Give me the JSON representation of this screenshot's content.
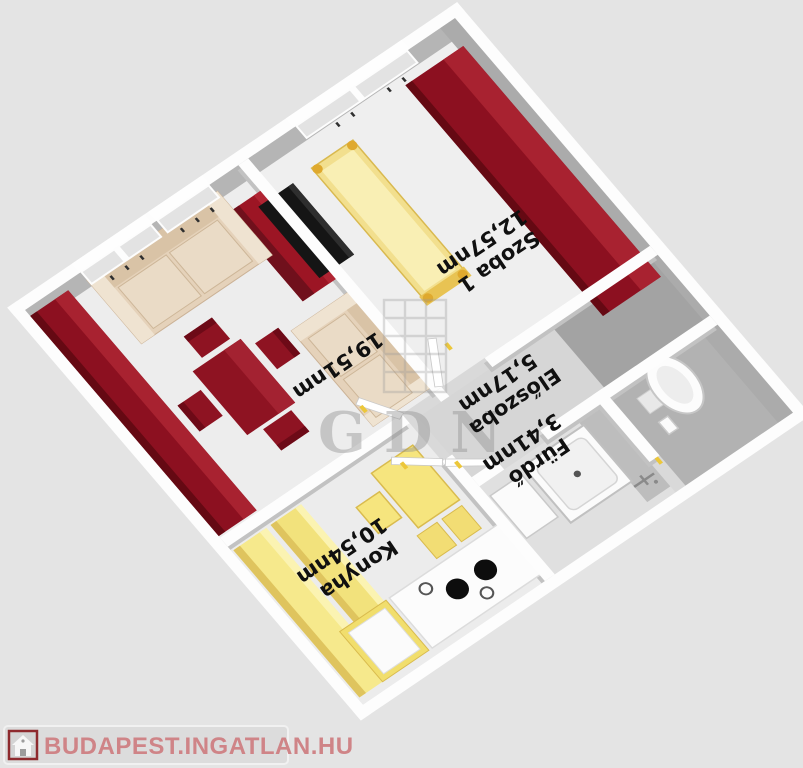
{
  "logo": {
    "text": "BUDAPEST.INGATLAN.HU",
    "icon": "house-icon"
  },
  "watermark": {
    "text": "GDN"
  },
  "rooms": {
    "szoba1": {
      "name": "Szoba 1",
      "area": "12,57nm"
    },
    "livingroom": {
      "area": "19,51nm"
    },
    "eloszoba": {
      "name": "Előszoba",
      "area": "5,17nm"
    },
    "furdo": {
      "name": "Fürdő",
      "area": "3,41nm"
    },
    "konyha": {
      "name": "Konyha",
      "area": "10,54nm"
    }
  },
  "colors": {
    "background": "#e4e4e4",
    "wall_white": "#fdfdfd",
    "wall_inner_gray": "#b0b0b0",
    "furniture_dark_red": "#8c1020",
    "furniture_yellow": "#f6e98c",
    "sofa_beige": "#e5d2ba",
    "label_text": "#101010",
    "logo_text": "#cf8487",
    "logo_border_red": "#8e2a2e"
  }
}
